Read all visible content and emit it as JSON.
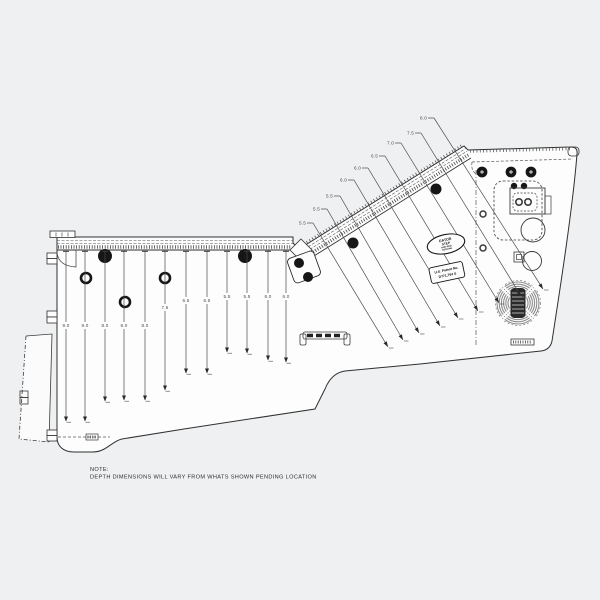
{
  "drawing": {
    "title": "deck template drawing",
    "background": "#eef0f1",
    "part_fill": "#fdfdfd",
    "line_color": "#303030",
    "dark_fill": "#161616",
    "speaker_gray": "#8d8d8d"
  },
  "note": {
    "title": "NOTE:",
    "body": "DEPTH DIMENSIONS WILL VARY FROM WHATS SHOWN PENDING LOCATION"
  },
  "logo": {
    "shape": "oval",
    "lines": [
      "GATOR",
      "STEP",
      "NON-SKID",
      "DECKING"
    ]
  },
  "patent": {
    "line1": "U.S. Patent No.",
    "line2": "D771,764 S"
  },
  "left_section": {
    "dimensions": [
      {
        "value": "9.0",
        "x": 66,
        "label_y": 327,
        "end_y": 421
      },
      {
        "value": "9.0",
        "x": 85,
        "label_y": 327,
        "end_y": 421
      },
      {
        "value": "8.0",
        "x": 105,
        "label_y": 327,
        "end_y": 401
      },
      {
        "value": "8.0",
        "x": 124,
        "label_y": 327,
        "end_y": 400
      },
      {
        "value": "8.0",
        "x": 145,
        "label_y": 327,
        "end_y": 400
      },
      {
        "value": "7.5",
        "x": 165,
        "label_y": 309,
        "end_y": 390
      },
      {
        "value": "6.5",
        "x": 186,
        "label_y": 302,
        "end_y": 373
      },
      {
        "value": "6.5",
        "x": 207,
        "label_y": 302,
        "end_y": 373
      },
      {
        "value": "5.5",
        "x": 227,
        "label_y": 298,
        "end_y": 352
      },
      {
        "value": "5.5",
        "x": 247,
        "label_y": 298,
        "end_y": 353
      },
      {
        "value": "6.0",
        "x": 268,
        "label_y": 298,
        "end_y": 360
      },
      {
        "value": "6.0",
        "x": 286,
        "label_y": 298,
        "end_y": 362
      }
    ]
  },
  "diagonal_section": {
    "dimensions": [
      {
        "value": "5.5",
        "label_x": 300,
        "label_y": 223,
        "end_x": 388,
        "end_y": 347
      },
      {
        "value": "5.5",
        "label_x": 314,
        "label_y": 209,
        "end_x": 403,
        "end_y": 340
      },
      {
        "value": "5.5",
        "label_x": 327,
        "label_y": 196,
        "end_x": 419,
        "end_y": 333
      },
      {
        "value": "6.0",
        "label_x": 341,
        "label_y": 180,
        "end_x": 440,
        "end_y": 326
      },
      {
        "value": "6.0",
        "label_x": 355,
        "label_y": 168,
        "end_x": 458,
        "end_y": 318
      },
      {
        "value": "6.5",
        "label_x": 372,
        "label_y": 156,
        "end_x": 478,
        "end_y": 311
      },
      {
        "value": "7.0",
        "label_x": 388,
        "label_y": 143,
        "end_x": 499,
        "end_y": 303
      },
      {
        "value": "7.5",
        "label_x": 408,
        "label_y": 133,
        "end_x": 521,
        "end_y": 296
      },
      {
        "value": "8.0",
        "label_x": 421,
        "label_y": 118,
        "end_x": 543,
        "end_y": 289
      }
    ]
  }
}
